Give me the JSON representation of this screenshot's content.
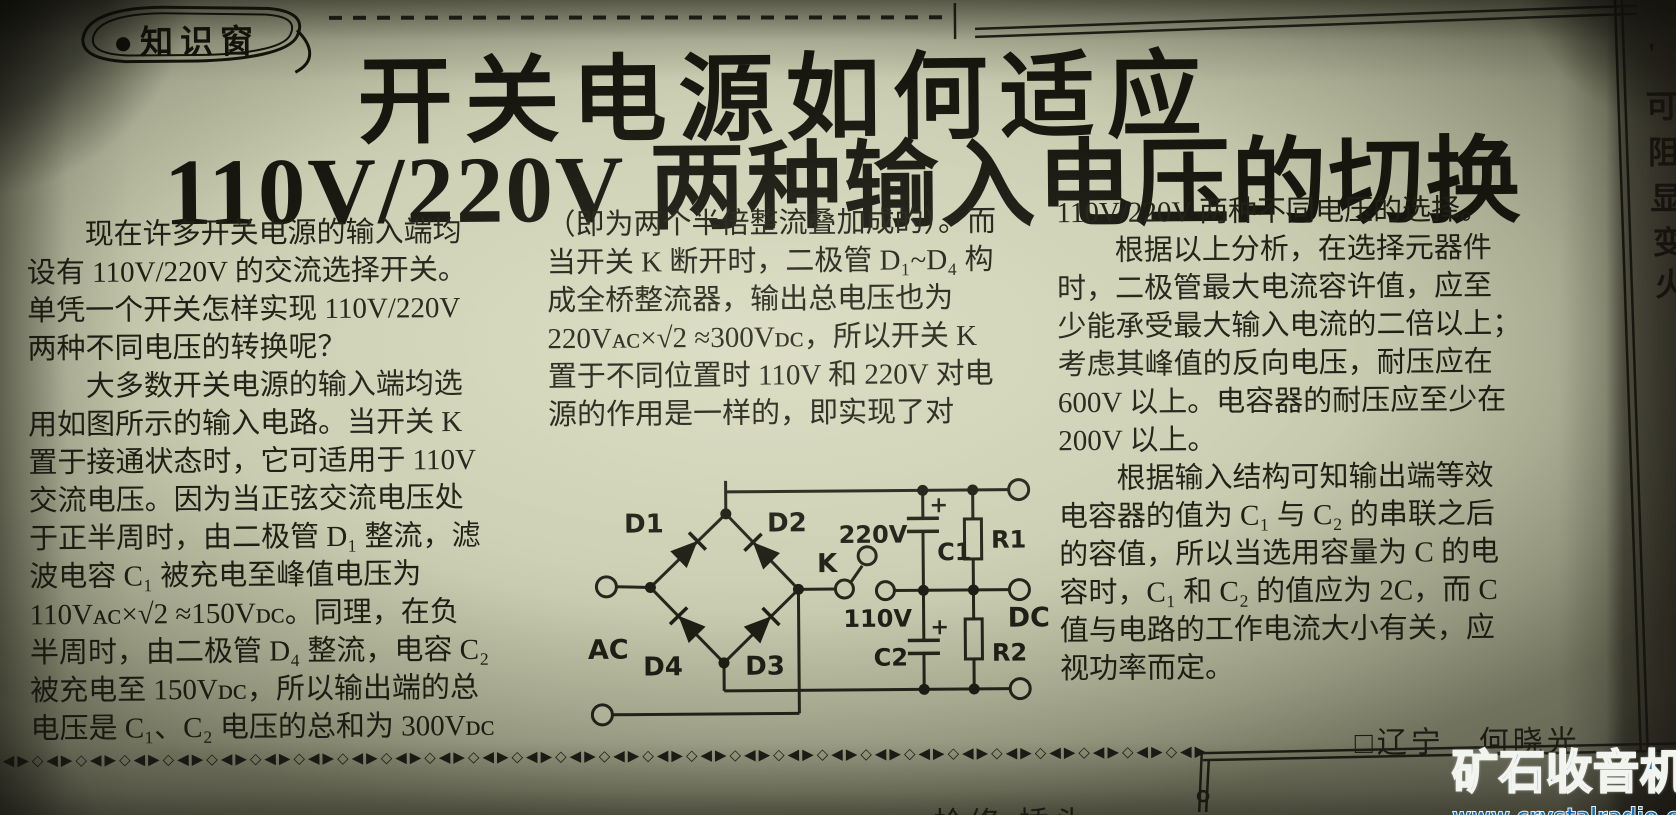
{
  "badge": {
    "label": "●知识窗"
  },
  "title": {
    "line1": "开关电源如何适应",
    "line2": "110V/220V 两种输入电压的切换"
  },
  "columns": {
    "col1": {
      "lines": [
        "　　现在许多开关电源的输入端均",
        "设有 110V/220V 的交流选择开关。",
        "单凭一个开关怎样实现 110V/220V",
        "两种不同电压的转换呢？",
        "　　大多数开关电源的输入端均选",
        "用如图所示的输入电路。当开关 K",
        "置于接通状态时，它可适用于 110V",
        "交流电压。因为当正弦交流电压处",
        "于正半周时，由二极管 D₁ 整流，滤",
        "波电容 C₁ 被充电至峰值电压为",
        "110Vᴀᴄ×√2 ≈150Vᴅᴄ。同理，在负",
        "半周时，由二极管 D₄ 整流，电容 C₂",
        "被充电至 150Vᴅᴄ，所以输出端的总",
        "电压是 C₁、C₂ 电压的总和为 300Vᴅᴄ"
      ]
    },
    "col2": {
      "lines": [
        "（即为两个半倍整流叠加成的）。而",
        "当开关 K 断开时，二极管 D₁~D₄ 构",
        "成全桥整流器，输出总电压也为",
        "220Vᴀᴄ×√2 ≈300Vᴅᴄ，所以开关 K",
        "置于不同位置时 110V 和 220V 对电",
        "源的作用是一样的，即实现了对"
      ]
    },
    "col3": {
      "lines": [
        "110V/220V 两种不同电压的选择。",
        "　　根据以上分析，在选择元器件",
        "时，二极管最大电流容许值，应至",
        "少能承受最大输入电流的二倍以上；",
        "考虑其峰值的反向电压，耐压应在",
        "600V 以上。电容器的耐压应至少在",
        "200V 以上。",
        "　　根据输入结构可知输出端等效",
        "电容器的值为 C₁ 与 C₂ 的串联之后",
        "的容值，所以当选用容量为 C 的电",
        "容时，C₁ 和 C₂ 的值应为 2C，而 C",
        "值与电路的工作电流大小有关，应",
        "视功率而定。"
      ],
      "author": "□辽宁　何晓光"
    }
  },
  "diagram": {
    "labels": {
      "d1": "D1",
      "d2": "D2",
      "d3": "D3",
      "d4": "D4",
      "k": "K",
      "v220": "220V",
      "v110": "110V",
      "c1": "C1",
      "c2": "C2",
      "r1": "R1",
      "r2": "R2",
      "ac": "AC",
      "dc": "DC",
      "plus": "+"
    }
  },
  "divider": {
    "pattern": "◀▶◇◀▶◇◀▶◇◀▶◇◀▶◇◀▶◇◀▶◇◀▶◇◀▶◇◀▶◇◀▶◇◀▶◇◀▶◇◀▶◇◀▶◇◀▶◇◀▶◇◀▶◇◀▶◇◀▶◇◀▶◇◀▶◇◀▶◇◀▶◇◀▶◇◀▶◇◀▶◇◀▶◇◀▶◇◀▶◇◀▶◇◀▶◇◀▶◇◀▶◇◀▶◇◀▶◇◀▶◇◀▶◇◀▶◇◀▶◇◀▶◇◀▶◇◀▶◇◀▶◇◀▶◇◀▶◇◀▶◇◀▶◇◀▶◇◀▶◇◀▶◇◀▶◇◀▶◇◀▶◇◀▶◇◀▶◇◀▶◇◀▶◇◀▶◇◀▶◇"
  },
  "fragments": {
    "bottom_text": "抢修 插头",
    "side_chars": [
      "'",
      "可",
      "阻",
      "显",
      "变",
      "火"
    ]
  },
  "watermark": {
    "name": "矿石收音机",
    "url": "www.crystalradio.cn",
    "color": "#1b6fb5"
  },
  "colors": {
    "paper": "#cdd0b4",
    "ink": "#202016",
    "watermark_blue": "#1b6fb5"
  }
}
